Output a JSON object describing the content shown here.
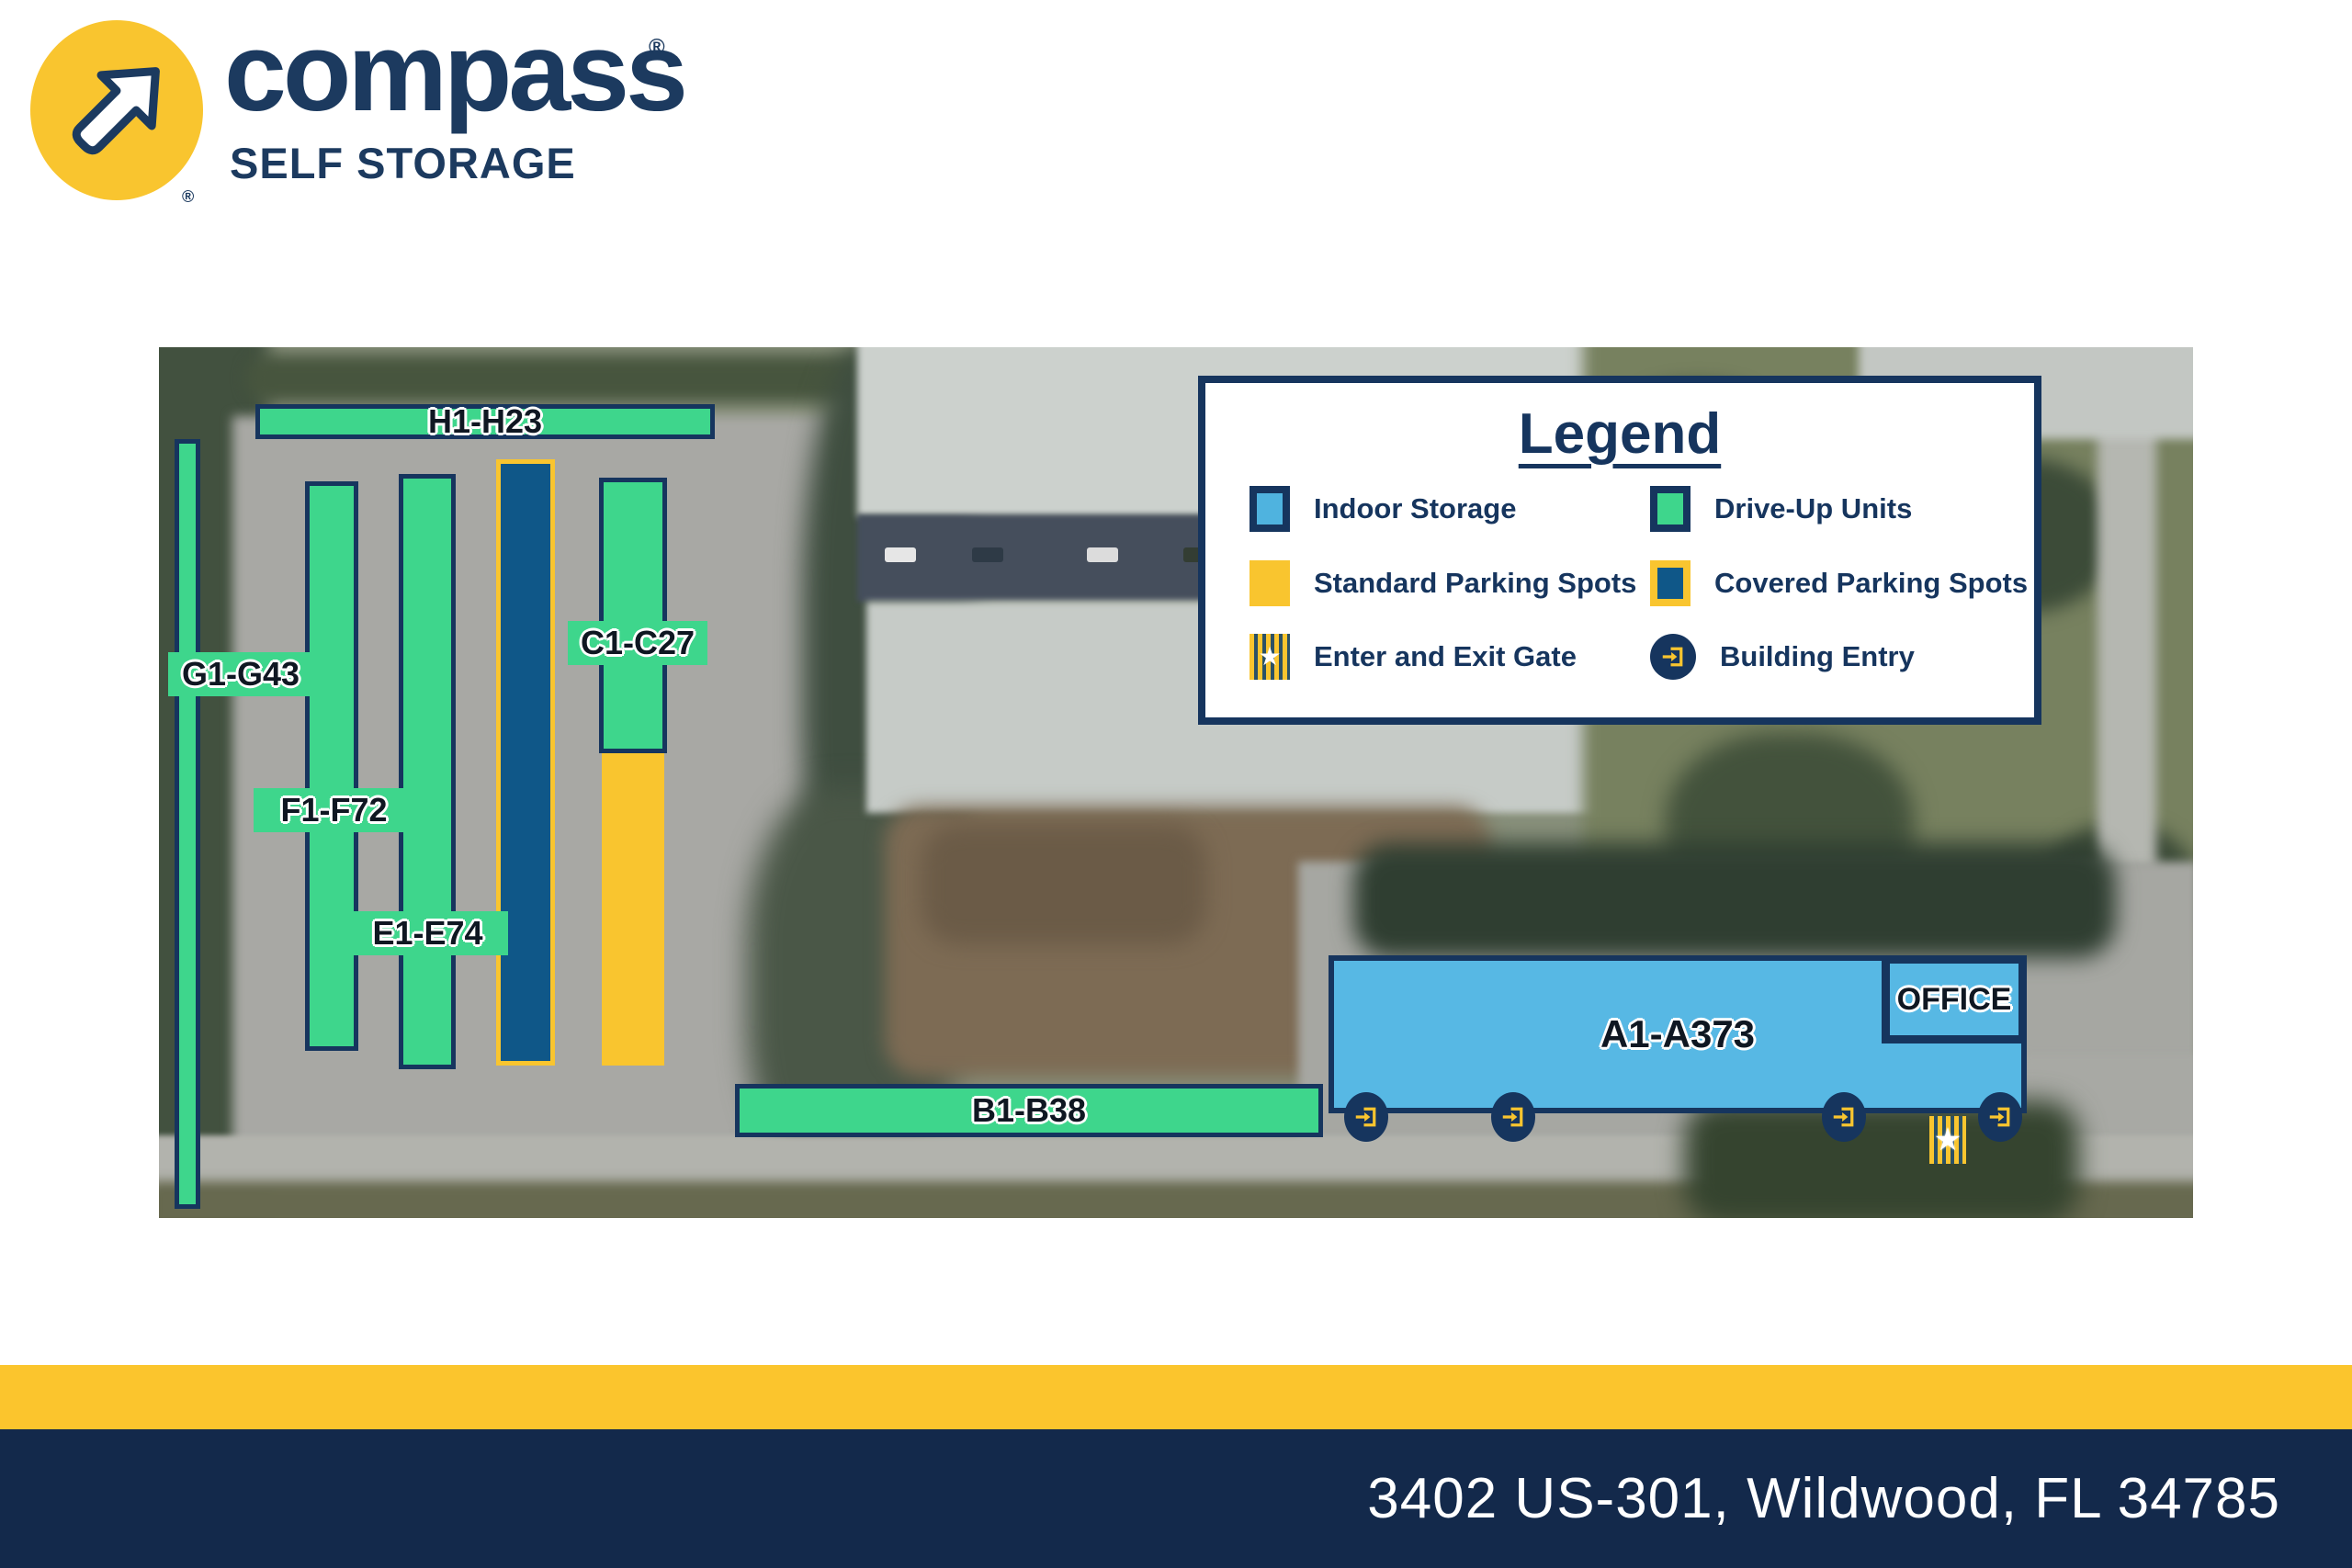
{
  "brand": {
    "wordmark": "compass",
    "tagline": "SELF STORAGE",
    "trademark": "®"
  },
  "legend": {
    "title": "Legend",
    "items": [
      {
        "id": "indoor-storage",
        "label": "Indoor Storage",
        "swatch": "indoor-blue-square"
      },
      {
        "id": "drive-up-units",
        "label": "Drive-Up Units",
        "swatch": "green-square"
      },
      {
        "id": "standard-parking",
        "label": "Standard Parking Spots",
        "swatch": "yellow-square"
      },
      {
        "id": "covered-parking",
        "label": "Covered Parking Spots",
        "swatch": "navy-square-yellow-border"
      },
      {
        "id": "enter-exit-gate",
        "label": "Enter and Exit Gate",
        "swatch": "striped-gate"
      },
      {
        "id": "building-entry",
        "label": "Building Entry",
        "swatch": "navy-circle-door-arrow"
      }
    ]
  },
  "map": {
    "units": [
      {
        "id": "H",
        "label": "H1-H23",
        "kind": "drive-up"
      },
      {
        "id": "G",
        "label": "G1-G43",
        "kind": "drive-up"
      },
      {
        "id": "F",
        "label": "F1-F72",
        "kind": "drive-up"
      },
      {
        "id": "E",
        "label": "E1-E74",
        "kind": "drive-up"
      },
      {
        "id": "C",
        "label": "C1-C27",
        "kind": "drive-up"
      },
      {
        "id": "B",
        "label": "B1-B38",
        "kind": "drive-up"
      },
      {
        "id": "A",
        "label": "A1-A373",
        "kind": "indoor"
      }
    ],
    "office_label": "OFFICE",
    "building_entry_count": 4,
    "gate_star": "★"
  },
  "footer": {
    "address": "3402 US-301, Wildwood, FL 34785"
  },
  "colors": {
    "navy": "#16355E",
    "footer_navy": "#13294B",
    "yellow": "#F9C52F",
    "drive_up_green": "#3ED68C",
    "indoor_blue": "#57B8E4",
    "covered_blue": "#0F5788",
    "label_text": "#0f1722"
  }
}
